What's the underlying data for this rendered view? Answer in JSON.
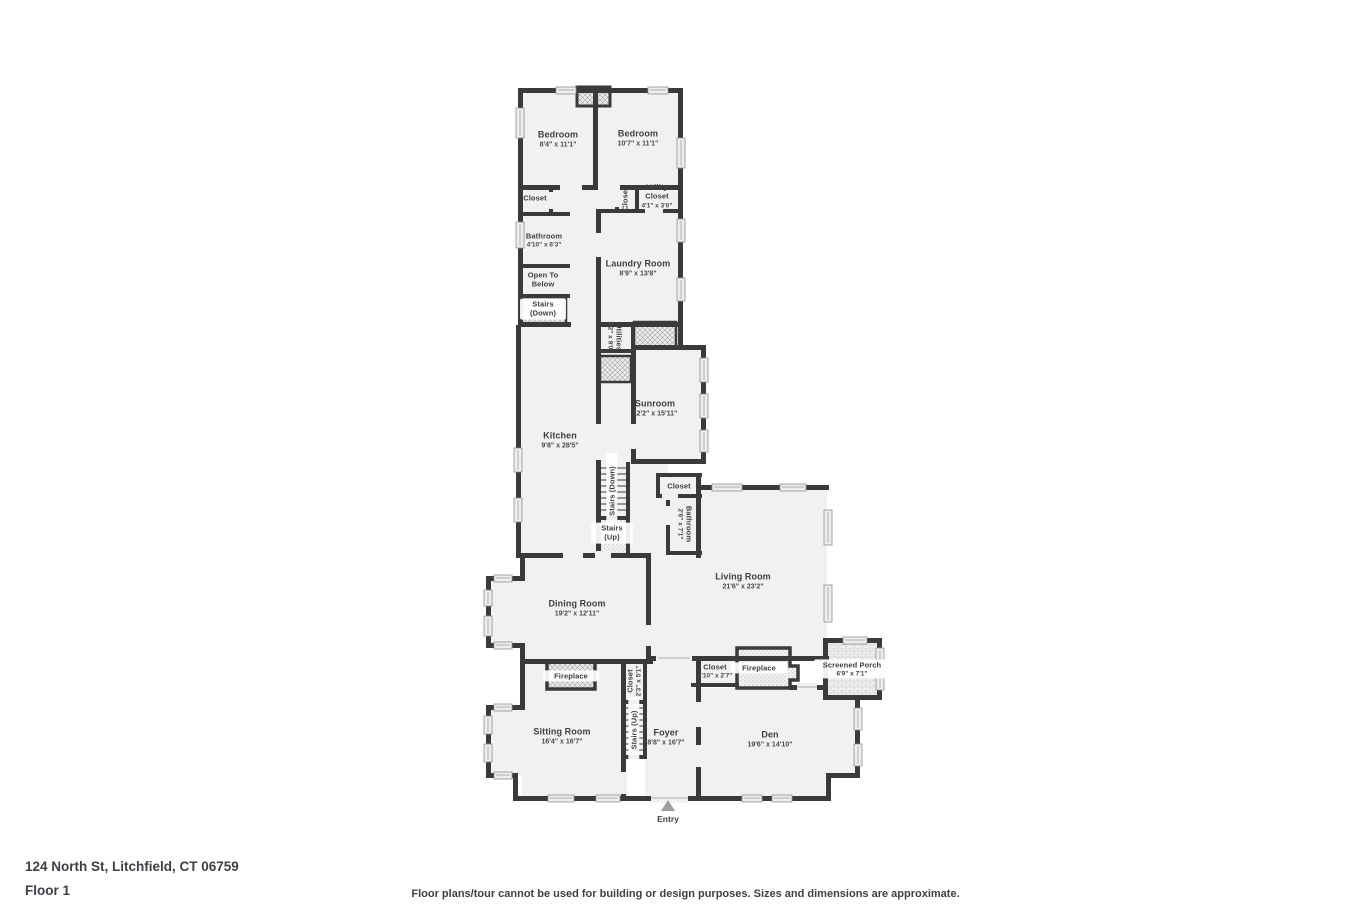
{
  "footer": {
    "address": "124 North St, Litchfield, CT 06759",
    "floor": "Floor 1",
    "disclaimer": "Floor plans/tour cannot be used for building or design purposes. Sizes and dimensions are approximate."
  },
  "entry": {
    "label": "Entry",
    "x": 668,
    "y": 814
  },
  "colors": {
    "wall": "#3a3a3a",
    "floor": "#f1f1f1",
    "window": "#ededed",
    "text": "#3f3f3f"
  },
  "rooms": [
    {
      "label": "Bedroom",
      "dims": "8'4\" x 11'1\"",
      "x": 558,
      "y": 139,
      "rot": 0,
      "w": 70
    },
    {
      "label": "Bedroom",
      "dims": "10'7\" x 11'1\"",
      "x": 638,
      "y": 138,
      "rot": 0,
      "w": 70
    },
    {
      "label": "Closet",
      "dims": "",
      "x": 535,
      "y": 198,
      "rot": 0,
      "w": 40,
      "small": true
    },
    {
      "label": "Closet",
      "dims": "",
      "x": 625,
      "y": 199,
      "rot": -90,
      "w": 60,
      "small": true
    },
    {
      "label": "Utility Closet",
      "dims": "4'1\" x 3'0\"",
      "x": 657,
      "y": 196,
      "rot": 0,
      "w": 34,
      "small": true
    },
    {
      "label": "Bathroom",
      "dims": "4'10\" x 6'3\"",
      "x": 544,
      "y": 240,
      "rot": 0,
      "w": 60,
      "small": true
    },
    {
      "label": "Open To Below",
      "dims": "",
      "x": 543,
      "y": 280,
      "rot": 0,
      "w": 42,
      "small": true
    },
    {
      "label": "Stairs (Down)",
      "dims": "",
      "x": 543,
      "y": 309,
      "rot": 0,
      "w": 40,
      "small": true,
      "plate": true
    },
    {
      "label": "Laundry Room",
      "dims": "8'9\" x 13'8\"",
      "x": 638,
      "y": 268,
      "rot": 0,
      "w": 70
    },
    {
      "label": "Utilities",
      "dims": "2'2\" x 9'0\"",
      "x": 615,
      "y": 337,
      "rot": 90,
      "w": 60,
      "small": true
    },
    {
      "label": "Sunroom",
      "dims": "12'2\" x 15'11\"",
      "x": 655,
      "y": 408,
      "rot": 0,
      "w": 70
    },
    {
      "label": "Kitchen",
      "dims": "9'8\" x 28'5\"",
      "x": 560,
      "y": 440,
      "rot": 0,
      "w": 70
    },
    {
      "label": "Stairs (Down)",
      "dims": "",
      "x": 612,
      "y": 491,
      "rot": -90,
      "w": 70,
      "small": true,
      "plate": true
    },
    {
      "label": "Stairs (Up)",
      "dims": "",
      "x": 612,
      "y": 533,
      "rot": 0,
      "w": 36,
      "small": true,
      "plate": true
    },
    {
      "label": "Closet",
      "dims": "",
      "x": 679,
      "y": 486,
      "rot": 0,
      "w": 40,
      "small": true
    },
    {
      "label": "Bathroom",
      "dims": "2'6\" x 7'1\"",
      "x": 685,
      "y": 524,
      "rot": 90,
      "w": 70,
      "small": true
    },
    {
      "label": "Living Room",
      "dims": "21'6\" x 23'2\"",
      "x": 743,
      "y": 581,
      "rot": 0,
      "w": 80
    },
    {
      "label": "Dining Room",
      "dims": "19'2\" x 12'11\"",
      "x": 577,
      "y": 608,
      "rot": 0,
      "w": 80
    },
    {
      "label": "Fireplace",
      "dims": "",
      "x": 571,
      "y": 676,
      "rot": 0,
      "w": 50,
      "small": true,
      "plate": true
    },
    {
      "label": "Closet",
      "dims": "2'3\" x 5'1\"",
      "x": 634,
      "y": 681,
      "rot": -90,
      "w": 70,
      "small": true
    },
    {
      "label": "Closet",
      "dims": "4'10\" x 2'7\"",
      "x": 715,
      "y": 671,
      "rot": 0,
      "w": 50,
      "small": true
    },
    {
      "label": "Fireplace",
      "dims": "",
      "x": 759,
      "y": 668,
      "rot": 0,
      "w": 50,
      "small": true,
      "plate": true
    },
    {
      "label": "Screened Porch",
      "dims": "6'9\" x 7'1\"",
      "x": 852,
      "y": 669,
      "rot": 0,
      "w": 70,
      "small": true,
      "plate": true
    },
    {
      "label": "Sitting Room",
      "dims": "16'4\" x 16'7\"",
      "x": 562,
      "y": 736,
      "rot": 0,
      "w": 80
    },
    {
      "label": "Stairs (Up)",
      "dims": "",
      "x": 634,
      "y": 730,
      "rot": -90,
      "w": 60,
      "small": true,
      "plate": true
    },
    {
      "label": "Foyer",
      "dims": "8'8\" x 16'7\"",
      "x": 666,
      "y": 737,
      "rot": 0,
      "w": 60
    },
    {
      "label": "Den",
      "dims": "19'6\" x 14'10\"",
      "x": 770,
      "y": 739,
      "rot": 0,
      "w": 70
    }
  ]
}
